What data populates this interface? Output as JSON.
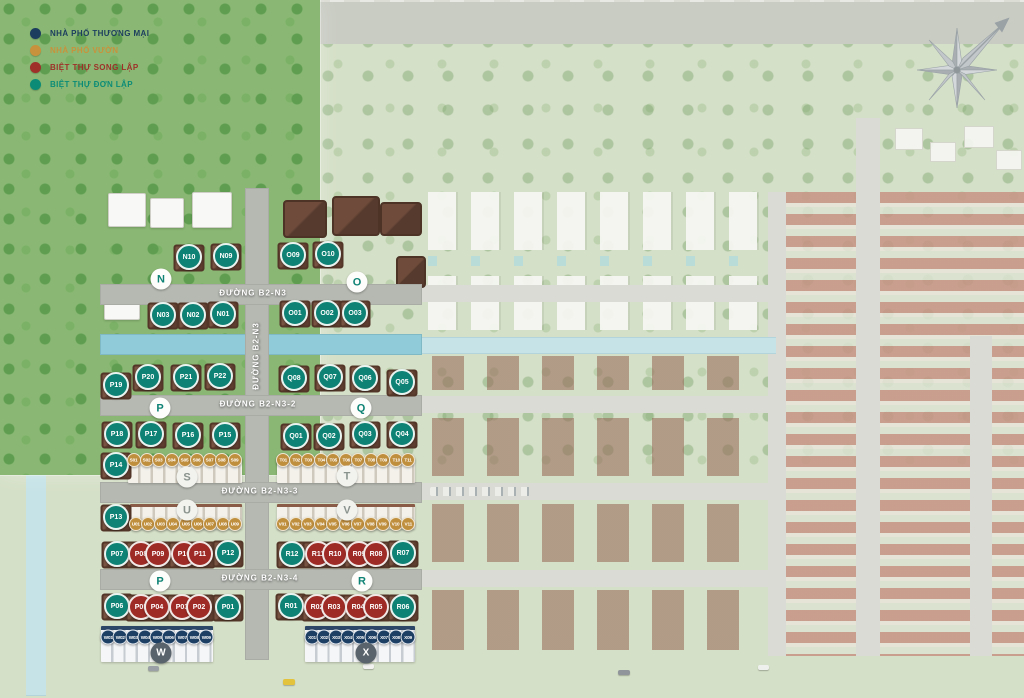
{
  "legend": {
    "items": [
      {
        "label": "NHÀ PHỐ THƯƠNG MẠI",
        "color": "#1c3d5e",
        "type": "thuong-mai"
      },
      {
        "label": "NHÀ PHỐ VƯỜN",
        "color": "#c8923c",
        "type": "vuon"
      },
      {
        "label": "BIỆT THỰ SONG LẬP",
        "color": "#9e3029",
        "type": "song-lap"
      },
      {
        "label": "BIỆT THỰ ĐƠN LẬP",
        "color": "#0c8c77",
        "type": "don-lap"
      }
    ]
  },
  "marker_colors": {
    "thuong-mai": "#1d3f63",
    "vuon": "#c08f3e",
    "song-lap": "#9e2b26",
    "don-lap": "#0e8274"
  },
  "roads": [
    {
      "label": "ĐƯỜNG B2-N3",
      "orientation": "horizontal",
      "x": 253,
      "y": 293
    },
    {
      "label": "ĐƯỜNG B2-N3",
      "orientation": "vertical",
      "x": 256,
      "y": 356
    },
    {
      "label": "ĐƯỜNG B2-N3-2",
      "orientation": "horizontal",
      "x": 258,
      "y": 404
    },
    {
      "label": "ĐƯỜNG B2-N3-3",
      "orientation": "horizontal",
      "x": 260,
      "y": 491
    },
    {
      "label": "ĐƯỜNG B2-N3-4",
      "orientation": "horizontal",
      "x": 260,
      "y": 578
    }
  ],
  "sections": [
    {
      "label": "N",
      "x": 161,
      "y": 279,
      "variant": "teal"
    },
    {
      "label": "O",
      "x": 357,
      "y": 282,
      "variant": "teal"
    },
    {
      "label": "P",
      "x": 160,
      "y": 408,
      "variant": "teal"
    },
    {
      "label": "Q",
      "x": 361,
      "y": 408,
      "variant": "teal"
    },
    {
      "label": "S",
      "x": 187,
      "y": 477,
      "variant": "gray"
    },
    {
      "label": "T",
      "x": 347,
      "y": 476,
      "variant": "gray"
    },
    {
      "label": "U",
      "x": 187,
      "y": 510,
      "variant": "gray"
    },
    {
      "label": "V",
      "x": 347,
      "y": 510,
      "variant": "gray"
    },
    {
      "label": "P",
      "x": 160,
      "y": 581,
      "variant": "teal"
    },
    {
      "label": "R",
      "x": 362,
      "y": 581,
      "variant": "teal"
    },
    {
      "label": "W",
      "x": 161,
      "y": 653,
      "variant": "dark"
    },
    {
      "label": "X",
      "x": 366,
      "y": 653,
      "variant": "dark"
    }
  ],
  "lots": [
    {
      "label": "N10",
      "x": 189,
      "y": 257,
      "type": "don-lap"
    },
    {
      "label": "N09",
      "x": 226,
      "y": 256,
      "type": "don-lap"
    },
    {
      "label": "O09",
      "x": 293,
      "y": 255,
      "type": "don-lap"
    },
    {
      "label": "O10",
      "x": 328,
      "y": 254,
      "type": "don-lap"
    },
    {
      "label": "N03",
      "x": 163,
      "y": 315,
      "type": "don-lap"
    },
    {
      "label": "N02",
      "x": 193,
      "y": 315,
      "type": "don-lap"
    },
    {
      "label": "N01",
      "x": 223,
      "y": 314,
      "type": "don-lap"
    },
    {
      "label": "O01",
      "x": 295,
      "y": 313,
      "type": "don-lap"
    },
    {
      "label": "O02",
      "x": 327,
      "y": 313,
      "type": "don-lap"
    },
    {
      "label": "O03",
      "x": 355,
      "y": 313,
      "type": "don-lap"
    },
    {
      "label": "P19",
      "x": 116,
      "y": 385,
      "type": "don-lap"
    },
    {
      "label": "P20",
      "x": 148,
      "y": 377,
      "type": "don-lap"
    },
    {
      "label": "P21",
      "x": 186,
      "y": 377,
      "type": "don-lap"
    },
    {
      "label": "P22",
      "x": 220,
      "y": 376,
      "type": "don-lap"
    },
    {
      "label": "Q08",
      "x": 294,
      "y": 378,
      "type": "don-lap"
    },
    {
      "label": "Q07",
      "x": 330,
      "y": 377,
      "type": "don-lap"
    },
    {
      "label": "Q06",
      "x": 365,
      "y": 378,
      "type": "don-lap"
    },
    {
      "label": "Q05",
      "x": 402,
      "y": 382,
      "type": "don-lap"
    },
    {
      "label": "P18",
      "x": 117,
      "y": 434,
      "type": "don-lap"
    },
    {
      "label": "P17",
      "x": 151,
      "y": 434,
      "type": "don-lap"
    },
    {
      "label": "P16",
      "x": 188,
      "y": 435,
      "type": "don-lap"
    },
    {
      "label": "P15",
      "x": 225,
      "y": 435,
      "type": "don-lap"
    },
    {
      "label": "Q01",
      "x": 296,
      "y": 436,
      "type": "don-lap"
    },
    {
      "label": "Q02",
      "x": 329,
      "y": 436,
      "type": "don-lap"
    },
    {
      "label": "Q03",
      "x": 365,
      "y": 434,
      "type": "don-lap"
    },
    {
      "label": "Q04",
      "x": 402,
      "y": 434,
      "type": "don-lap"
    },
    {
      "label": "P14",
      "x": 116,
      "y": 465,
      "type": "don-lap"
    },
    {
      "label": "P13",
      "x": 116,
      "y": 517,
      "type": "don-lap"
    },
    {
      "label": "S01",
      "x": 134,
      "y": 460,
      "type": "vuon"
    },
    {
      "label": "S02",
      "x": 147,
      "y": 460,
      "type": "vuon"
    },
    {
      "label": "S03",
      "x": 159,
      "y": 460,
      "type": "vuon"
    },
    {
      "label": "S04",
      "x": 172,
      "y": 460,
      "type": "vuon"
    },
    {
      "label": "S05",
      "x": 185,
      "y": 460,
      "type": "vuon"
    },
    {
      "label": "S06",
      "x": 197,
      "y": 460,
      "type": "vuon"
    },
    {
      "label": "S07",
      "x": 210,
      "y": 460,
      "type": "vuon"
    },
    {
      "label": "S08",
      "x": 222,
      "y": 460,
      "type": "vuon"
    },
    {
      "label": "S09",
      "x": 235,
      "y": 460,
      "type": "vuon"
    },
    {
      "label": "T01",
      "x": 283,
      "y": 460,
      "type": "vuon"
    },
    {
      "label": "T02",
      "x": 296,
      "y": 460,
      "type": "vuon"
    },
    {
      "label": "T03",
      "x": 308,
      "y": 460,
      "type": "vuon"
    },
    {
      "label": "T04",
      "x": 321,
      "y": 460,
      "type": "vuon"
    },
    {
      "label": "T05",
      "x": 333,
      "y": 460,
      "type": "vuon"
    },
    {
      "label": "T06",
      "x": 346,
      "y": 460,
      "type": "vuon"
    },
    {
      "label": "T07",
      "x": 358,
      "y": 460,
      "type": "vuon"
    },
    {
      "label": "T08",
      "x": 371,
      "y": 460,
      "type": "vuon"
    },
    {
      "label": "T09",
      "x": 383,
      "y": 460,
      "type": "vuon"
    },
    {
      "label": "T10",
      "x": 396,
      "y": 460,
      "type": "vuon"
    },
    {
      "label": "T11",
      "x": 408,
      "y": 460,
      "type": "vuon"
    },
    {
      "label": "U01",
      "x": 136,
      "y": 524,
      "type": "vuon"
    },
    {
      "label": "U02",
      "x": 148,
      "y": 524,
      "type": "vuon"
    },
    {
      "label": "U03",
      "x": 161,
      "y": 524,
      "type": "vuon"
    },
    {
      "label": "U04",
      "x": 173,
      "y": 524,
      "type": "vuon"
    },
    {
      "label": "U05",
      "x": 186,
      "y": 524,
      "type": "vuon"
    },
    {
      "label": "U06",
      "x": 198,
      "y": 524,
      "type": "vuon"
    },
    {
      "label": "U07",
      "x": 210,
      "y": 524,
      "type": "vuon"
    },
    {
      "label": "U08",
      "x": 223,
      "y": 524,
      "type": "vuon"
    },
    {
      "label": "U09",
      "x": 235,
      "y": 524,
      "type": "vuon"
    },
    {
      "label": "V01",
      "x": 283,
      "y": 524,
      "type": "vuon"
    },
    {
      "label": "V02",
      "x": 296,
      "y": 524,
      "type": "vuon"
    },
    {
      "label": "V03",
      "x": 308,
      "y": 524,
      "type": "vuon"
    },
    {
      "label": "V04",
      "x": 321,
      "y": 524,
      "type": "vuon"
    },
    {
      "label": "V05",
      "x": 333,
      "y": 524,
      "type": "vuon"
    },
    {
      "label": "V06",
      "x": 346,
      "y": 524,
      "type": "vuon"
    },
    {
      "label": "V07",
      "x": 358,
      "y": 524,
      "type": "vuon"
    },
    {
      "label": "V08",
      "x": 371,
      "y": 524,
      "type": "vuon"
    },
    {
      "label": "V09",
      "x": 383,
      "y": 524,
      "type": "vuon"
    },
    {
      "label": "V10",
      "x": 396,
      "y": 524,
      "type": "vuon"
    },
    {
      "label": "V11",
      "x": 408,
      "y": 524,
      "type": "vuon"
    },
    {
      "label": "P07",
      "x": 117,
      "y": 554,
      "type": "don-lap"
    },
    {
      "label": "P08",
      "x": 141,
      "y": 554,
      "type": "song-lap"
    },
    {
      "label": "P09",
      "x": 158,
      "y": 554,
      "type": "song-lap"
    },
    {
      "label": "P10",
      "x": 184,
      "y": 554,
      "type": "song-lap"
    },
    {
      "label": "P11",
      "x": 200,
      "y": 554,
      "type": "song-lap"
    },
    {
      "label": "P12",
      "x": 228,
      "y": 553,
      "type": "don-lap"
    },
    {
      "label": "R12",
      "x": 292,
      "y": 554,
      "type": "don-lap"
    },
    {
      "label": "R11",
      "x": 318,
      "y": 554,
      "type": "song-lap"
    },
    {
      "label": "R10",
      "x": 335,
      "y": 554,
      "type": "song-lap"
    },
    {
      "label": "R09",
      "x": 359,
      "y": 554,
      "type": "song-lap"
    },
    {
      "label": "R08",
      "x": 376,
      "y": 554,
      "type": "song-lap"
    },
    {
      "label": "R07",
      "x": 403,
      "y": 553,
      "type": "don-lap"
    },
    {
      "label": "P06",
      "x": 117,
      "y": 606,
      "type": "don-lap"
    },
    {
      "label": "P05",
      "x": 141,
      "y": 607,
      "type": "song-lap"
    },
    {
      "label": "P04",
      "x": 157,
      "y": 607,
      "type": "song-lap"
    },
    {
      "label": "P03",
      "x": 182,
      "y": 607,
      "type": "song-lap"
    },
    {
      "label": "P02",
      "x": 199,
      "y": 607,
      "type": "song-lap"
    },
    {
      "label": "P01",
      "x": 228,
      "y": 607,
      "type": "don-lap"
    },
    {
      "label": "R01",
      "x": 291,
      "y": 606,
      "type": "don-lap"
    },
    {
      "label": "R02",
      "x": 317,
      "y": 607,
      "type": "song-lap"
    },
    {
      "label": "R03",
      "x": 334,
      "y": 607,
      "type": "song-lap"
    },
    {
      "label": "R04",
      "x": 358,
      "y": 607,
      "type": "song-lap"
    },
    {
      "label": "R05",
      "x": 376,
      "y": 607,
      "type": "song-lap"
    },
    {
      "label": "R06",
      "x": 403,
      "y": 607,
      "type": "don-lap"
    },
    {
      "label": "W01",
      "x": 108,
      "y": 637,
      "type": "thuong-mai"
    },
    {
      "label": "W02",
      "x": 120,
      "y": 637,
      "type": "thuong-mai"
    },
    {
      "label": "W03",
      "x": 133,
      "y": 637,
      "type": "thuong-mai"
    },
    {
      "label": "W04",
      "x": 145,
      "y": 637,
      "type": "thuong-mai"
    },
    {
      "label": "W05",
      "x": 157,
      "y": 637,
      "type": "thuong-mai"
    },
    {
      "label": "W06",
      "x": 169,
      "y": 637,
      "type": "thuong-mai"
    },
    {
      "label": "W07",
      "x": 182,
      "y": 637,
      "type": "thuong-mai"
    },
    {
      "label": "W08",
      "x": 194,
      "y": 637,
      "type": "thuong-mai"
    },
    {
      "label": "W09",
      "x": 206,
      "y": 637,
      "type": "thuong-mai"
    },
    {
      "label": "X01",
      "x": 312,
      "y": 637,
      "type": "thuong-mai"
    },
    {
      "label": "X02",
      "x": 324,
      "y": 637,
      "type": "thuong-mai"
    },
    {
      "label": "X03",
      "x": 336,
      "y": 637,
      "type": "thuong-mai"
    },
    {
      "label": "X04",
      "x": 348,
      "y": 637,
      "type": "thuong-mai"
    },
    {
      "label": "X05",
      "x": 360,
      "y": 637,
      "type": "thuong-mai"
    },
    {
      "label": "X06",
      "x": 372,
      "y": 637,
      "type": "thuong-mai"
    },
    {
      "label": "X07",
      "x": 384,
      "y": 637,
      "type": "thuong-mai"
    },
    {
      "label": "X08",
      "x": 396,
      "y": 637,
      "type": "thuong-mai"
    },
    {
      "label": "X09",
      "x": 408,
      "y": 637,
      "type": "thuong-mai"
    }
  ]
}
